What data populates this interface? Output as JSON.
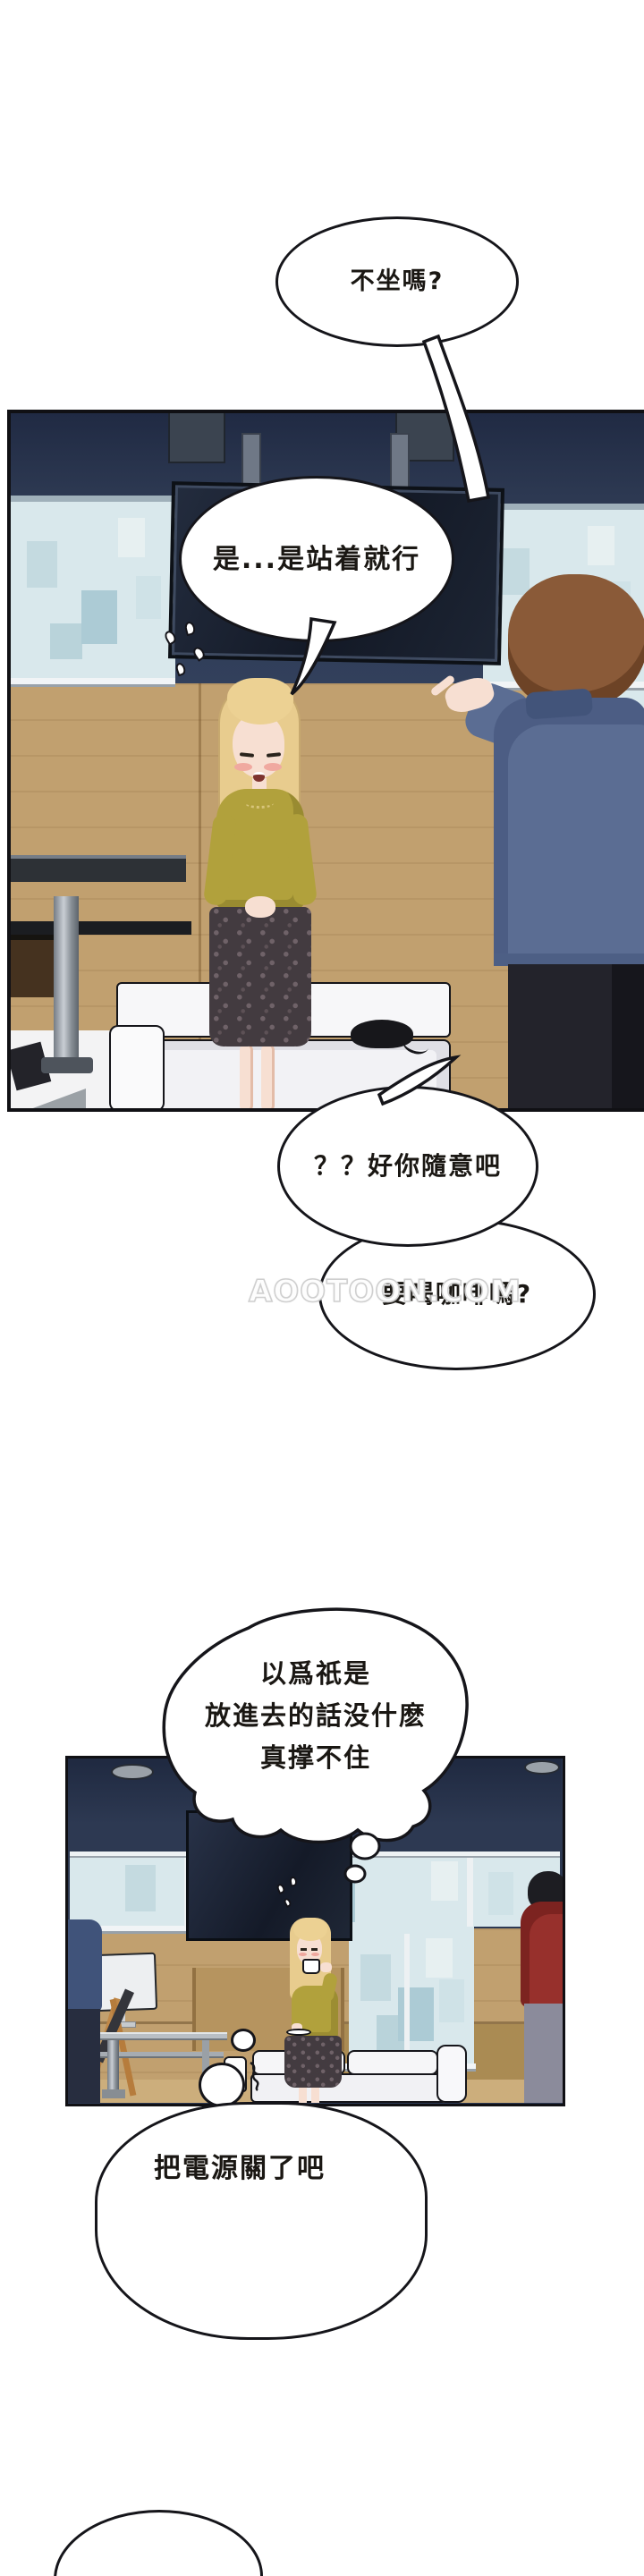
{
  "comic": {
    "bubble1": "不坐嗎?",
    "bubble2": "是...是站着就行",
    "bubble3": "？？好你隨意吧",
    "bubble4": "要喝咖啡嗎?",
    "thought": {
      "line1": "以爲祇是",
      "line2": "放進去的話没什麽",
      "line3": "真撑不住"
    },
    "bubble6": "把電源關了吧"
  },
  "watermark": {
    "text": "AOOTOON.COM"
  },
  "palette": {
    "wall_navy": "#2d3952",
    "wall_navy_dark": "#212b44",
    "window_glass": "#d9e8ec",
    "wood": "#c1a06f",
    "tv_screen": "#151b28",
    "couch_white": "#f5f5f7",
    "sweater_mustard": "#b1a13c",
    "hair_blonde": "#e8cc8e",
    "skirt_dark": "#433b40",
    "man_hair_brown": "#8a5a38",
    "jacket_blue": "#5b6d93",
    "pants_black": "#23232b",
    "hoodie_red": "#97302c",
    "skin": "#f7dfd2",
    "outline_black": "#15151a"
  }
}
